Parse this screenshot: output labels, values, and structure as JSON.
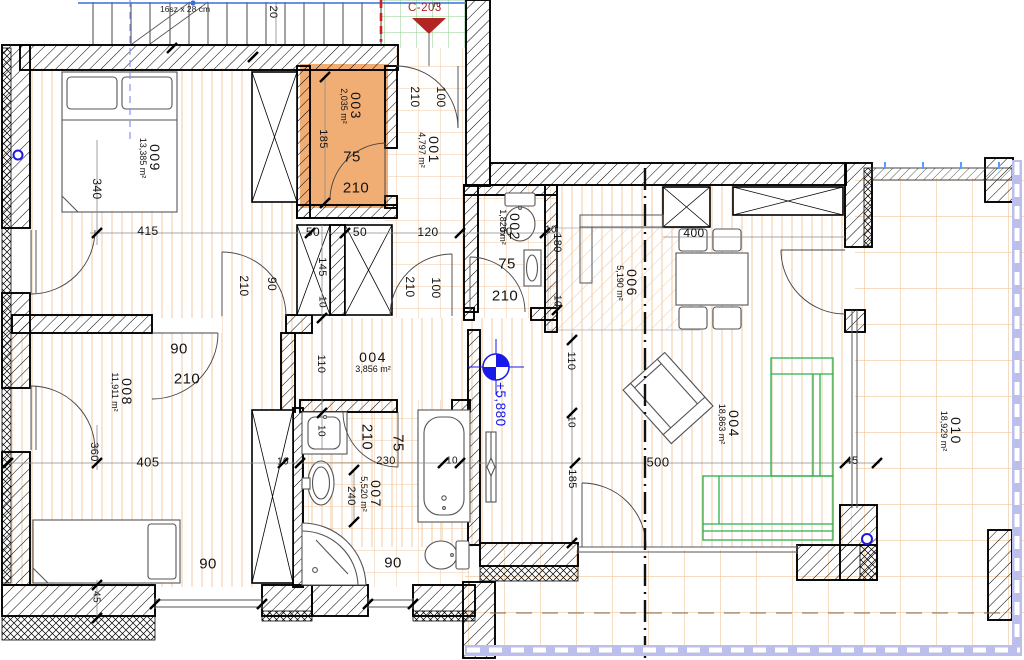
{
  "annotations": {
    "stair_note": "16sz x 28 cm",
    "section_ref": "C-203",
    "corridor_letter": "E",
    "level": "+5,880"
  },
  "palette": {
    "wall": "#000000",
    "highlight_room": "#f1ae74",
    "floor_line": "#f0c9a2",
    "terrace_line": "#f0c496",
    "green_grid": "#8cd08c",
    "sofa_green": "#29b24a",
    "marker_blue": "#1a1ae8",
    "ref_red": "#b32424",
    "lavender": "#bcbfec"
  },
  "rooms": [
    {
      "id": "009",
      "area": "13,385 m²",
      "x": 150,
      "y": 158,
      "r": 90
    },
    {
      "id": "003",
      "area": "2,035 m²",
      "x": 351,
      "y": 106,
      "r": 90
    },
    {
      "id": "001",
      "area": "4,797 m²",
      "x": 429,
      "y": 150,
      "r": 90
    },
    {
      "id": "002",
      "area": "1,820 m²",
      "x": 510,
      "y": 227,
      "r": 90
    },
    {
      "id": "006",
      "area": "5,190 m²",
      "x": 627,
      "y": 283,
      "r": 90
    },
    {
      "id": "004",
      "area": "3,856 m²",
      "x": 373,
      "y": 362,
      "r": 0
    },
    {
      "id": "008",
      "area": "11,911 m²",
      "x": 122,
      "y": 392,
      "r": 90
    },
    {
      "id": "007",
      "area": "5,520 m²",
      "x": 371,
      "y": 494,
      "r": 90
    },
    {
      "id": "004",
      "area": "18,863 m²",
      "x": 729,
      "y": 424,
      "r": 90
    },
    {
      "id": "010",
      "area": "18,929 m²",
      "x": 951,
      "y": 431,
      "r": 90
    }
  ],
  "dimensions": [
    {
      "t": "20",
      "x": 273,
      "y": 12,
      "r": 90,
      "s": 11
    },
    {
      "t": "100",
      "x": 441,
      "y": 97,
      "r": 90,
      "s": 12
    },
    {
      "t": "210",
      "x": 415,
      "y": 97,
      "r": 90,
      "s": 12
    },
    {
      "t": "415",
      "x": 148,
      "y": 231,
      "r": 0,
      "s": 12
    },
    {
      "t": "50",
      "x": 313,
      "y": 232,
      "r": 0,
      "s": 12
    },
    {
      "t": "50",
      "x": 360,
      "y": 232,
      "r": 0,
      "s": 12
    },
    {
      "t": "120",
      "x": 428,
      "y": 232,
      "r": 0,
      "s": 12
    },
    {
      "t": "90",
      "x": 506,
      "y": 232,
      "r": 0,
      "s": 11
    },
    {
      "t": "10",
      "x": 551,
      "y": 230,
      "r": 0,
      "s": 10
    },
    {
      "t": "340",
      "x": 97,
      "y": 189,
      "r": 90,
      "s": 12
    },
    {
      "t": "185",
      "x": 323,
      "y": 139,
      "r": 90,
      "s": 11
    },
    {
      "t": "75",
      "x": 352,
      "y": 157,
      "r": 0,
      "s": 15
    },
    {
      "t": "210",
      "x": 356,
      "y": 188,
      "r": 0,
      "s": 15
    },
    {
      "t": "145",
      "x": 322,
      "y": 267,
      "r": 90,
      "s": 11
    },
    {
      "t": "10",
      "x": 322,
      "y": 302,
      "r": 90,
      "s": 10
    },
    {
      "t": "180",
      "x": 557,
      "y": 243,
      "r": 90,
      "s": 11
    },
    {
      "t": "10",
      "x": 557,
      "y": 301,
      "r": 90,
      "s": 10
    },
    {
      "t": "400",
      "x": 694,
      "y": 233,
      "r": 0,
      "s": 12
    },
    {
      "t": "90",
      "x": 272,
      "y": 284,
      "r": 90,
      "s": 12
    },
    {
      "t": "210",
      "x": 244,
      "y": 286,
      "r": 90,
      "s": 12
    },
    {
      "t": "210",
      "x": 410,
      "y": 287,
      "r": 90,
      "s": 12
    },
    {
      "t": "100",
      "x": 436,
      "y": 288,
      "r": 90,
      "s": 12
    },
    {
      "t": "75",
      "x": 507,
      "y": 264,
      "r": 0,
      "s": 15
    },
    {
      "t": "210",
      "x": 505,
      "y": 296,
      "r": 0,
      "s": 15
    },
    {
      "t": "110",
      "x": 321,
      "y": 364,
      "r": 90,
      "s": 11
    },
    {
      "t": "10",
      "x": 321,
      "y": 431,
      "r": 90,
      "s": 10
    },
    {
      "t": "90",
      "x": 179,
      "y": 349,
      "r": 0,
      "s": 15
    },
    {
      "t": "210",
      "x": 187,
      "y": 379,
      "r": 0,
      "s": 15
    },
    {
      "t": "110",
      "x": 571,
      "y": 361,
      "r": 90,
      "s": 11
    },
    {
      "t": "10",
      "x": 571,
      "y": 422,
      "r": 90,
      "s": 10
    },
    {
      "t": "185",
      "x": 572,
      "y": 479,
      "r": 90,
      "s": 11
    },
    {
      "t": "360",
      "x": 94,
      "y": 452,
      "r": 90,
      "s": 11
    },
    {
      "t": "405",
      "x": 148,
      "y": 462,
      "r": 0,
      "s": 13
    },
    {
      "t": "10",
      "x": 283,
      "y": 462,
      "r": 0,
      "s": 10
    },
    {
      "t": "210",
      "x": 367,
      "y": 437,
      "r": 90,
      "s": 15
    },
    {
      "t": "75",
      "x": 398,
      "y": 443,
      "r": 90,
      "s": 15
    },
    {
      "t": "230",
      "x": 386,
      "y": 461,
      "r": 0,
      "s": 11
    },
    {
      "t": "10",
      "x": 452,
      "y": 461,
      "r": 0,
      "s": 10
    },
    {
      "t": "240",
      "x": 351,
      "y": 496,
      "r": 90,
      "s": 11
    },
    {
      "t": "500",
      "x": 658,
      "y": 462,
      "r": 0,
      "s": 13
    },
    {
      "t": "45",
      "x": 852,
      "y": 461,
      "r": 0,
      "s": 11
    },
    {
      "t": "90",
      "x": 208,
      "y": 564,
      "r": 0,
      "s": 15
    },
    {
      "t": "90",
      "x": 393,
      "y": 563,
      "r": 0,
      "s": 15
    },
    {
      "t": "45",
      "x": 96,
      "y": 597,
      "r": 90,
      "s": 10
    }
  ]
}
